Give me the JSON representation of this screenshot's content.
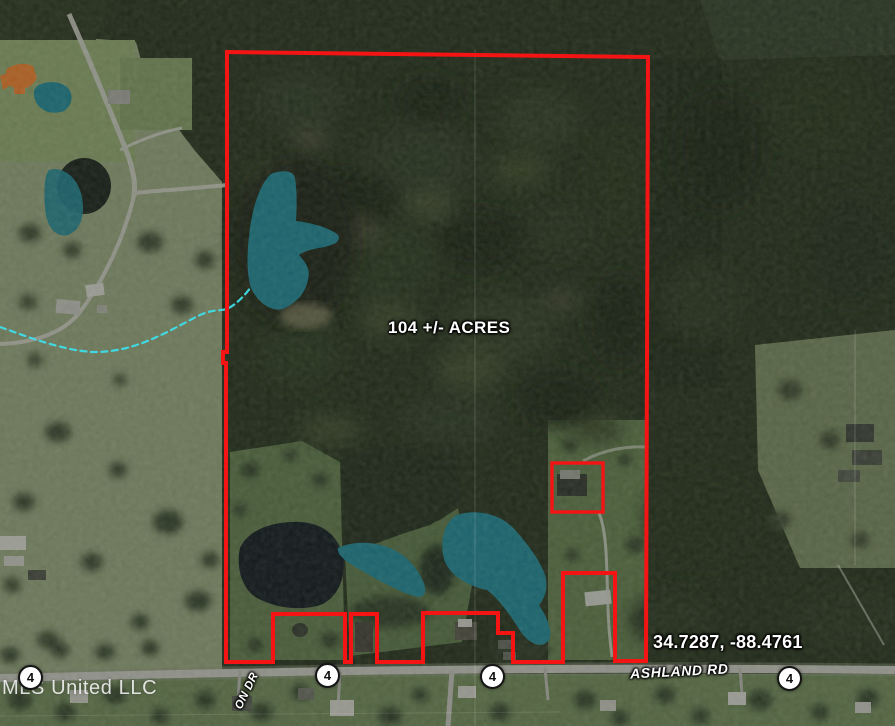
{
  "map": {
    "type": "satellite-property-map",
    "acreage_label": "104 +/- ACRES",
    "coordinates_label": "34.7287, -88.4761",
    "road_label": "ASHLAND RD",
    "side_road_label": "ON DR",
    "watermark": "MLS United LLC",
    "route_markers": [
      {
        "label": "4"
      },
      {
        "label": "4"
      },
      {
        "label": "4"
      },
      {
        "label": "4"
      }
    ],
    "colors": {
      "boundary": "#f41414",
      "water_highlight": "#1d8596",
      "building_highlight": "#ee7e2c",
      "stream": "#3fdde8"
    }
  }
}
